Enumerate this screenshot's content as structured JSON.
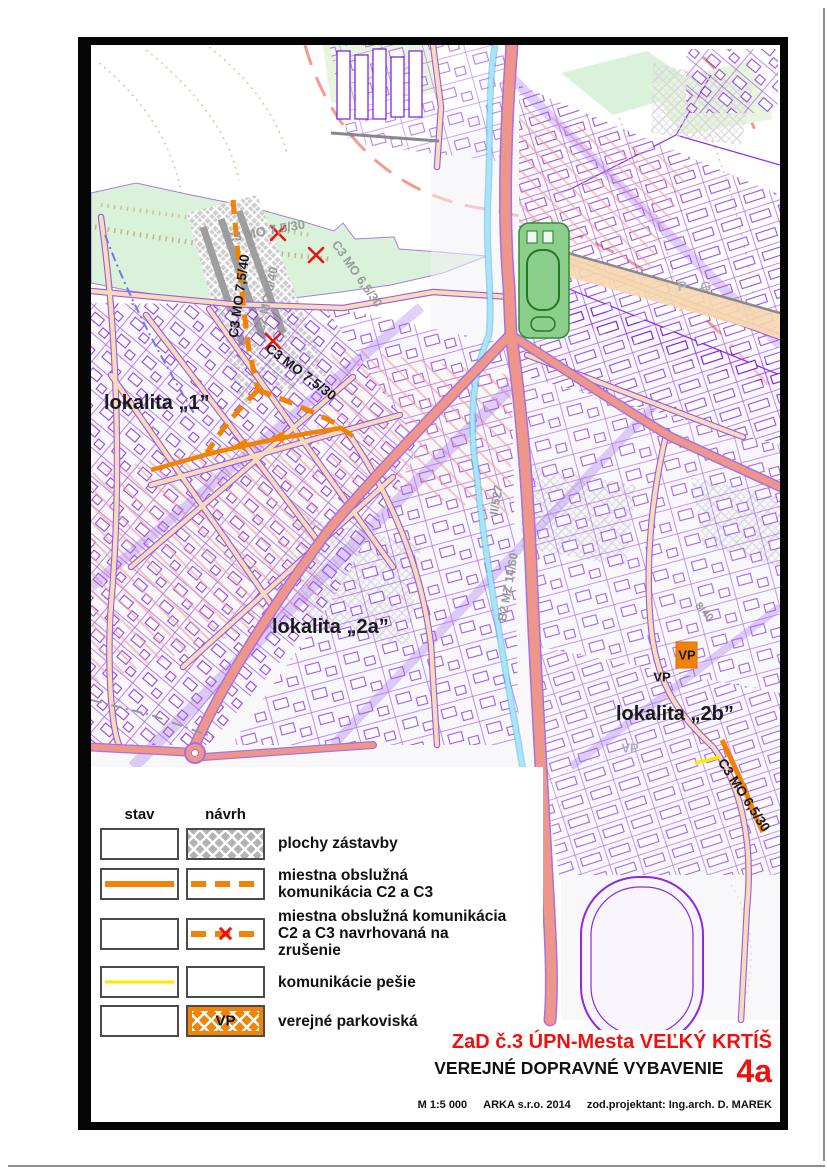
{
  "map": {
    "locality_labels": {
      "lok1": "lokalita „1”",
      "lok2a": "lokalita „2a”",
      "lok2b": "lokalita „2b”"
    },
    "proposed_road_labels": {
      "c3_7540": "C3 MO 7,5/40",
      "c3_7530": "C3 MO 7,5/30",
      "c3_6530": "C3 MO 6,5/30"
    },
    "existing_road_labels": {
      "c3_7530_cancelled": "C3 MO 7,5/30",
      "c2_840": "C2 MO 8/40",
      "c3_6530_gray": "C3 MO 6,5/30",
      "ii_527": "II/527",
      "b2_mz": "B2 MZ 14/60",
      "pg": "P G",
      "r840": "8/40",
      "vp_gray": "VP"
    },
    "parking_labels": {
      "vp1": "VP",
      "vp2": "VP"
    }
  },
  "legend": {
    "col_stav": "stav",
    "col_navrh": "návrh",
    "rows": [
      {
        "label": "plochy zástavby"
      },
      {
        "label": "miestna obslužná\nkomunikácia C2 a C3"
      },
      {
        "label": "miestna obslužná komunikácia\nC2 a C3 navrhovaná na zrušenie"
      },
      {
        "label": "komunikácie pešie"
      },
      {
        "label": "verejné parkoviská",
        "symbol": "VP"
      }
    ]
  },
  "title_block": {
    "title": "ZaD č.3 ÚPN-Mesta VEĽKÝ KRTÍŠ",
    "subtitle": "VEREJNÉ DOPRAVNÉ VYBAVENIE",
    "sheet": "4a",
    "scale": "M 1:5 000",
    "firm": "ARKA s.r.o.  2014",
    "designer": "zod.projektant: Ing.arch. D. MAREK"
  },
  "colors": {
    "proposal_orange": "#f2830a",
    "cancel_red": "#e61414",
    "title_red": "#ee1111",
    "main_road_pink": "#ef968b",
    "stream_cyan": "#a5e6fa",
    "parcel_purple": "#8a2be2",
    "pedestrian_yellow": "#ffe800",
    "zastavba_gray": "#b3b3b3",
    "greenery": "#d9f2d9"
  }
}
